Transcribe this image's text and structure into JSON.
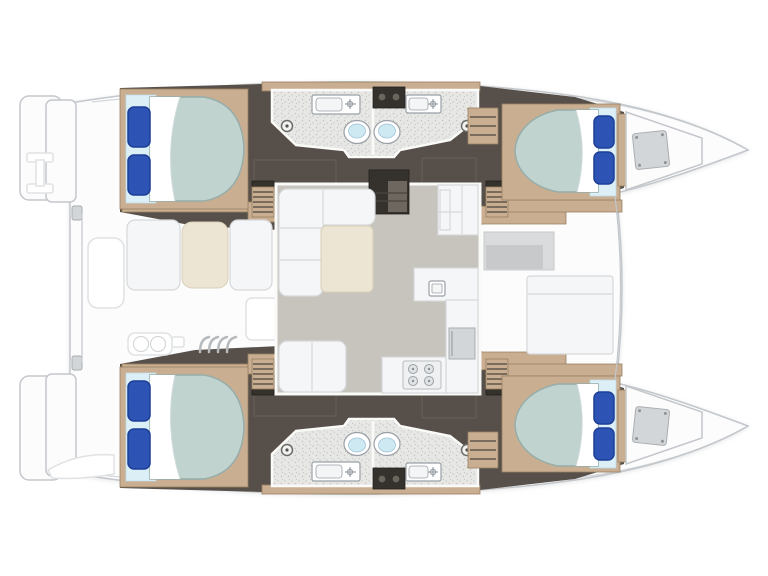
{
  "image": {
    "description": "Top-down interior floor plan of a four-cabin sailing catamaran, bow pointing right",
    "width_px": 768,
    "height_px": 576
  },
  "palette": {
    "background": "#ffffff",
    "deck_white": "#fcfcfd",
    "outline_gray": "#c3c7cb",
    "shadow_gray": "#e3e6e8",
    "wall_white": "#fafaf8",
    "floor_dark": "#57504a",
    "floor_panel": "#6b635a",
    "wood_tan": "#c9ae92",
    "wood_edge": "#99805f",
    "bath_floor": "#e7e7e5",
    "bath_speckle": "#c6c6c4",
    "mattress": "#c0d3cf",
    "mattress_edge": "#96ada9",
    "sheet_white": "#ffffff",
    "bed_head": "#dceff6",
    "pillow_blue": "#2d54b5",
    "pillow_edge": "#1c3e95",
    "toilet_lid": "#cfe9f3",
    "fixture_stroke": "#9aa0a6",
    "salon_floor": "#c7c4be",
    "furniture_white": "#f5f6f7",
    "furniture_stroke": "#d5d8da",
    "table_cream": "#ece5d3",
    "table_edge": "#d8cfb8",
    "dark_block": "#35322d",
    "hatch_gray": "#d3d6d8",
    "recess_gray": "#d9dbdc",
    "recess_inner": "#c7c9ca"
  },
  "vessel": {
    "view": "top-down",
    "orientation": "bow-right",
    "hull_count": 2,
    "cabin_count": 4,
    "head_count": 4,
    "hulls": [
      {
        "id": "port-top",
        "spaces": [
          "stern-platform",
          "aft-double-berth",
          "aft-head",
          "forward-head",
          "forward-double-berth",
          "bow-locker"
        ]
      },
      {
        "id": "starboard-bottom",
        "spaces": [
          "stern-platform",
          "aft-double-berth",
          "aft-head",
          "forward-head",
          "forward-double-berth",
          "bow-locker"
        ]
      }
    ],
    "berth": {
      "pillows_per_berth": 2,
      "pillow_color": "#2d54b5",
      "mattress_color": "#c0d3cf"
    },
    "head_fixtures": [
      "washbasin",
      "toilet",
      "shower-drain"
    ],
    "bridge_deck": {
      "cockpit_features": [
        "bench-seats",
        "cockpit-table",
        "twin-sink-unit",
        "rope-lines"
      ],
      "salon_features": [
        "l-shaped-sofa",
        "coffee-table",
        "aft-bench",
        "nav-cabinet",
        "entry-steps-block"
      ],
      "galley_features": [
        "galley-sink",
        "refrigerator",
        "four-burner-stove",
        "l-shaped-counter"
      ],
      "foredeck_features": [
        "recessed-locker",
        "sun-pad"
      ]
    }
  }
}
